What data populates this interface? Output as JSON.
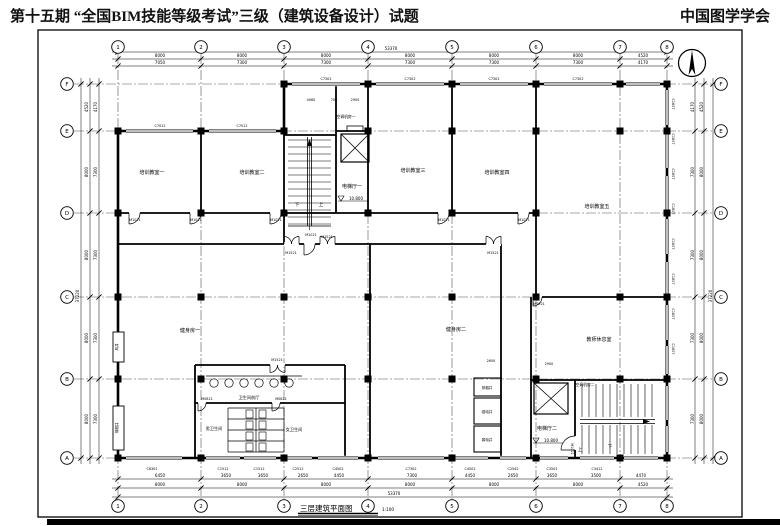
{
  "header": {
    "exam_title": "第十五期 “全国BIM技能等级考试”三级（建筑设备设计）试题",
    "organization": "中国图学学会"
  },
  "drawing": {
    "title": "三层建筑平面图",
    "scale": "1:100"
  },
  "grid": {
    "cols": [
      "1",
      "2",
      "3",
      "4",
      "5",
      "6",
      "7",
      "8"
    ],
    "col_x": [
      118,
      201,
      284,
      368,
      452,
      536,
      620,
      667
    ],
    "rows": [
      "F",
      "E",
      "D",
      "C",
      "B",
      "A"
    ],
    "row_y": [
      84,
      131,
      213,
      297,
      379,
      458
    ]
  },
  "rooms": [
    {
      "name": "培训教室一",
      "x": 152,
      "y": 174
    },
    {
      "name": "培训教室二",
      "x": 252,
      "y": 174
    },
    {
      "name": "培训教室三",
      "x": 413,
      "y": 172
    },
    {
      "name": "培训教室四",
      "x": 497,
      "y": 174
    },
    {
      "name": "培训教室五",
      "x": 597,
      "y": 208
    },
    {
      "name": "电梯厅一",
      "x": 352,
      "y": 188
    },
    {
      "name": "空调机房一",
      "x": 346,
      "y": 118,
      "s": 3.8
    },
    {
      "name": "健身房一",
      "x": 190,
      "y": 332
    },
    {
      "name": "健身房二",
      "x": 456,
      "y": 331
    },
    {
      "name": "教师休息室",
      "x": 599,
      "y": 341
    },
    {
      "name": "卫生间前厅",
      "x": 249,
      "y": 399,
      "s": 4.2
    },
    {
      "name": "男卫生间",
      "x": 214,
      "y": 430,
      "s": 4.2
    },
    {
      "name": "女卫生间",
      "x": 294,
      "y": 431,
      "s": 4.2
    },
    {
      "name": "电梯厅二",
      "x": 547,
      "y": 430
    },
    {
      "name": "空调机房二",
      "x": 585,
      "y": 386,
      "s": 3.8
    },
    {
      "name": "排烟井",
      "x": 487,
      "y": 389,
      "s": 3.6
    },
    {
      "name": "强电井",
      "x": 487,
      "y": 413,
      "s": 3.6
    },
    {
      "name": "弱电井",
      "x": 487,
      "y": 441,
      "s": 3.6
    },
    {
      "name": "风井",
      "x": 118,
      "y": 347,
      "s": 3.6,
      "r": -90
    },
    {
      "name": "排烟井",
      "x": 118,
      "y": 428,
      "s": 3.6,
      "r": -90
    }
  ],
  "stair_labels": [
    {
      "t": "下",
      "x": 297,
      "y": 206
    },
    {
      "t": "上",
      "x": 321,
      "y": 206
    },
    {
      "t": "上",
      "x": 580,
      "y": 451
    },
    {
      "t": "下",
      "x": 610,
      "y": 448
    }
  ],
  "levels": [
    {
      "v": "10.800",
      "x": 352,
      "y": 200
    },
    {
      "v": "10.800",
      "x": 547,
      "y": 442
    }
  ],
  "tags": [
    {
      "t": "C7012",
      "x": 160,
      "y": 127
    },
    {
      "t": "C7012",
      "x": 242,
      "y": 127
    },
    {
      "t": "C7302",
      "x": 326,
      "y": 80
    },
    {
      "t": "C7302",
      "x": 410,
      "y": 80
    },
    {
      "t": "C7302",
      "x": 494,
      "y": 80
    },
    {
      "t": "C7302",
      "x": 578,
      "y": 80
    },
    {
      "t": "C1807",
      "x": 672,
      "y": 104,
      "r": 90
    },
    {
      "t": "C1807",
      "x": 672,
      "y": 139,
      "r": 90
    },
    {
      "t": "C1807",
      "x": 672,
      "y": 174,
      "r": 90
    },
    {
      "t": "C1807",
      "x": 672,
      "y": 209,
      "r": 90
    },
    {
      "t": "C1807",
      "x": 672,
      "y": 244,
      "r": 90
    },
    {
      "t": "C1807",
      "x": 672,
      "y": 279,
      "r": 90
    },
    {
      "t": "C1807",
      "x": 672,
      "y": 314,
      "r": 90
    },
    {
      "t": "C1807",
      "x": 672,
      "y": 349,
      "r": 90
    },
    {
      "t": "C6302",
      "x": 152,
      "y": 470
    },
    {
      "t": "C1512",
      "x": 223,
      "y": 470
    },
    {
      "t": "C1512",
      "x": 259,
      "y": 470
    },
    {
      "t": "C2512",
      "x": 298,
      "y": 470
    },
    {
      "t": "C4502",
      "x": 338,
      "y": 470
    },
    {
      "t": "C7302",
      "x": 411,
      "y": 470
    },
    {
      "t": "C4502",
      "x": 470,
      "y": 470
    },
    {
      "t": "C2542",
      "x": 513,
      "y": 470
    },
    {
      "t": "C3502",
      "x": 552,
      "y": 470
    },
    {
      "t": "C3412",
      "x": 597,
      "y": 470
    },
    {
      "t": "M1021",
      "x": 135,
      "y": 221
    },
    {
      "t": "M1021",
      "x": 196,
      "y": 221
    },
    {
      "t": "M1021",
      "x": 276,
      "y": 221
    },
    {
      "t": "M1021",
      "x": 444,
      "y": 221
    },
    {
      "t": "M1021",
      "x": 524,
      "y": 221
    },
    {
      "t": "M1021",
      "x": 311,
      "y": 236
    },
    {
      "t": "M1021",
      "x": 571,
      "y": 449,
      "r": 90
    },
    {
      "t": "M1521",
      "x": 291,
      "y": 254
    },
    {
      "t": "M1521",
      "x": 327,
      "y": 238
    },
    {
      "t": "M1521",
      "x": 493,
      "y": 254
    },
    {
      "t": "M1521",
      "x": 277,
      "y": 361
    },
    {
      "t": "M0821",
      "x": 207,
      "y": 400
    },
    {
      "t": "M0821",
      "x": 281,
      "y": 400
    },
    {
      "t": "M0921",
      "x": 539,
      "y": 305
    }
  ],
  "dims": {
    "top_total": {
      "t": "53370",
      "x": 391,
      "y": 50
    },
    "top_main": {
      "y": 57,
      "items": [
        {
          "t": "8000",
          "x": 160
        },
        {
          "t": "8000",
          "x": 242
        },
        {
          "t": "8000",
          "x": 326
        },
        {
          "t": "8000",
          "x": 410
        },
        {
          "t": "8000",
          "x": 494
        },
        {
          "t": "8000",
          "x": 578
        },
        {
          "t": "4520",
          "x": 643
        }
      ]
    },
    "top_inner": {
      "y": 64,
      "items": [
        {
          "t": "7050",
          "x": 160
        },
        {
          "t": "7300",
          "x": 242
        },
        {
          "t": "7300",
          "x": 326
        },
        {
          "t": "7300",
          "x": 410
        },
        {
          "t": "7300",
          "x": 494
        },
        {
          "t": "7300",
          "x": 578
        },
        {
          "t": "4170",
          "x": 643
        }
      ]
    },
    "bottom_inner": {
      "y": 477,
      "items": [
        {
          "t": "6450",
          "x": 160
        },
        {
          "t": "3650",
          "x": 226
        },
        {
          "t": "3650",
          "x": 263
        },
        {
          "t": "2650",
          "x": 303
        },
        {
          "t": "4450",
          "x": 339
        },
        {
          "t": "7300",
          "x": 412
        },
        {
          "t": "4450",
          "x": 470
        },
        {
          "t": "2650",
          "x": 513
        },
        {
          "t": "3650",
          "x": 552
        },
        {
          "t": "3500",
          "x": 596
        },
        {
          "t": "4470",
          "x": 641
        }
      ]
    },
    "bottom_main": {
      "y": 486,
      "items": [
        {
          "t": "8000",
          "x": 160
        },
        {
          "t": "8000",
          "x": 242
        },
        {
          "t": "8000",
          "x": 326
        },
        {
          "t": "8000",
          "x": 410
        },
        {
          "t": "8000",
          "x": 494
        },
        {
          "t": "8000",
          "x": 578
        },
        {
          "t": "4520",
          "x": 643
        }
      ]
    },
    "bottom_total": {
      "t": "53370",
      "x": 394,
      "y": 495
    },
    "left_main": {
      "x": 88,
      "items": [
        {
          "t": "4520",
          "y": 107
        },
        {
          "t": "8000",
          "y": 172
        },
        {
          "t": "8000",
          "y": 255
        },
        {
          "t": "8000",
          "y": 338
        },
        {
          "t": "8000",
          "y": 419
        }
      ]
    },
    "left_inner": {
      "x": 97,
      "items": [
        {
          "t": "4170",
          "y": 107
        },
        {
          "t": "7300",
          "y": 172
        },
        {
          "t": "7300",
          "y": 255
        },
        {
          "t": "7300",
          "y": 338
        },
        {
          "t": "7300",
          "y": 419
        }
      ]
    },
    "left_total": {
      "t": "37220",
      "x": 79,
      "y": 296
    },
    "right_inner": {
      "x": 694,
      "items": [
        {
          "t": "4170",
          "y": 107
        },
        {
          "t": "7300",
          "y": 172
        },
        {
          "t": "7300",
          "y": 255
        },
        {
          "t": "7300",
          "y": 338
        },
        {
          "t": "7300",
          "y": 419
        }
      ]
    },
    "right_main": {
      "x": 703,
      "items": [
        {
          "t": "4520",
          "y": 107
        },
        {
          "t": "8000",
          "y": 172
        },
        {
          "t": "8000",
          "y": 255
        },
        {
          "t": "8000",
          "y": 338
        },
        {
          "t": "8000",
          "y": 419
        }
      ]
    },
    "right_total": {
      "t": "37220",
      "x": 712,
      "y": 296
    },
    "interior": [
      {
        "t": "4060",
        "x": 311,
        "y": 101
      },
      {
        "t": "700",
        "x": 334,
        "y": 101
      },
      {
        "t": "2900",
        "x": 355,
        "y": 101
      },
      {
        "t": "2650",
        "x": 491,
        "y": 362
      },
      {
        "t": "2900",
        "x": 549,
        "y": 365
      }
    ]
  }
}
